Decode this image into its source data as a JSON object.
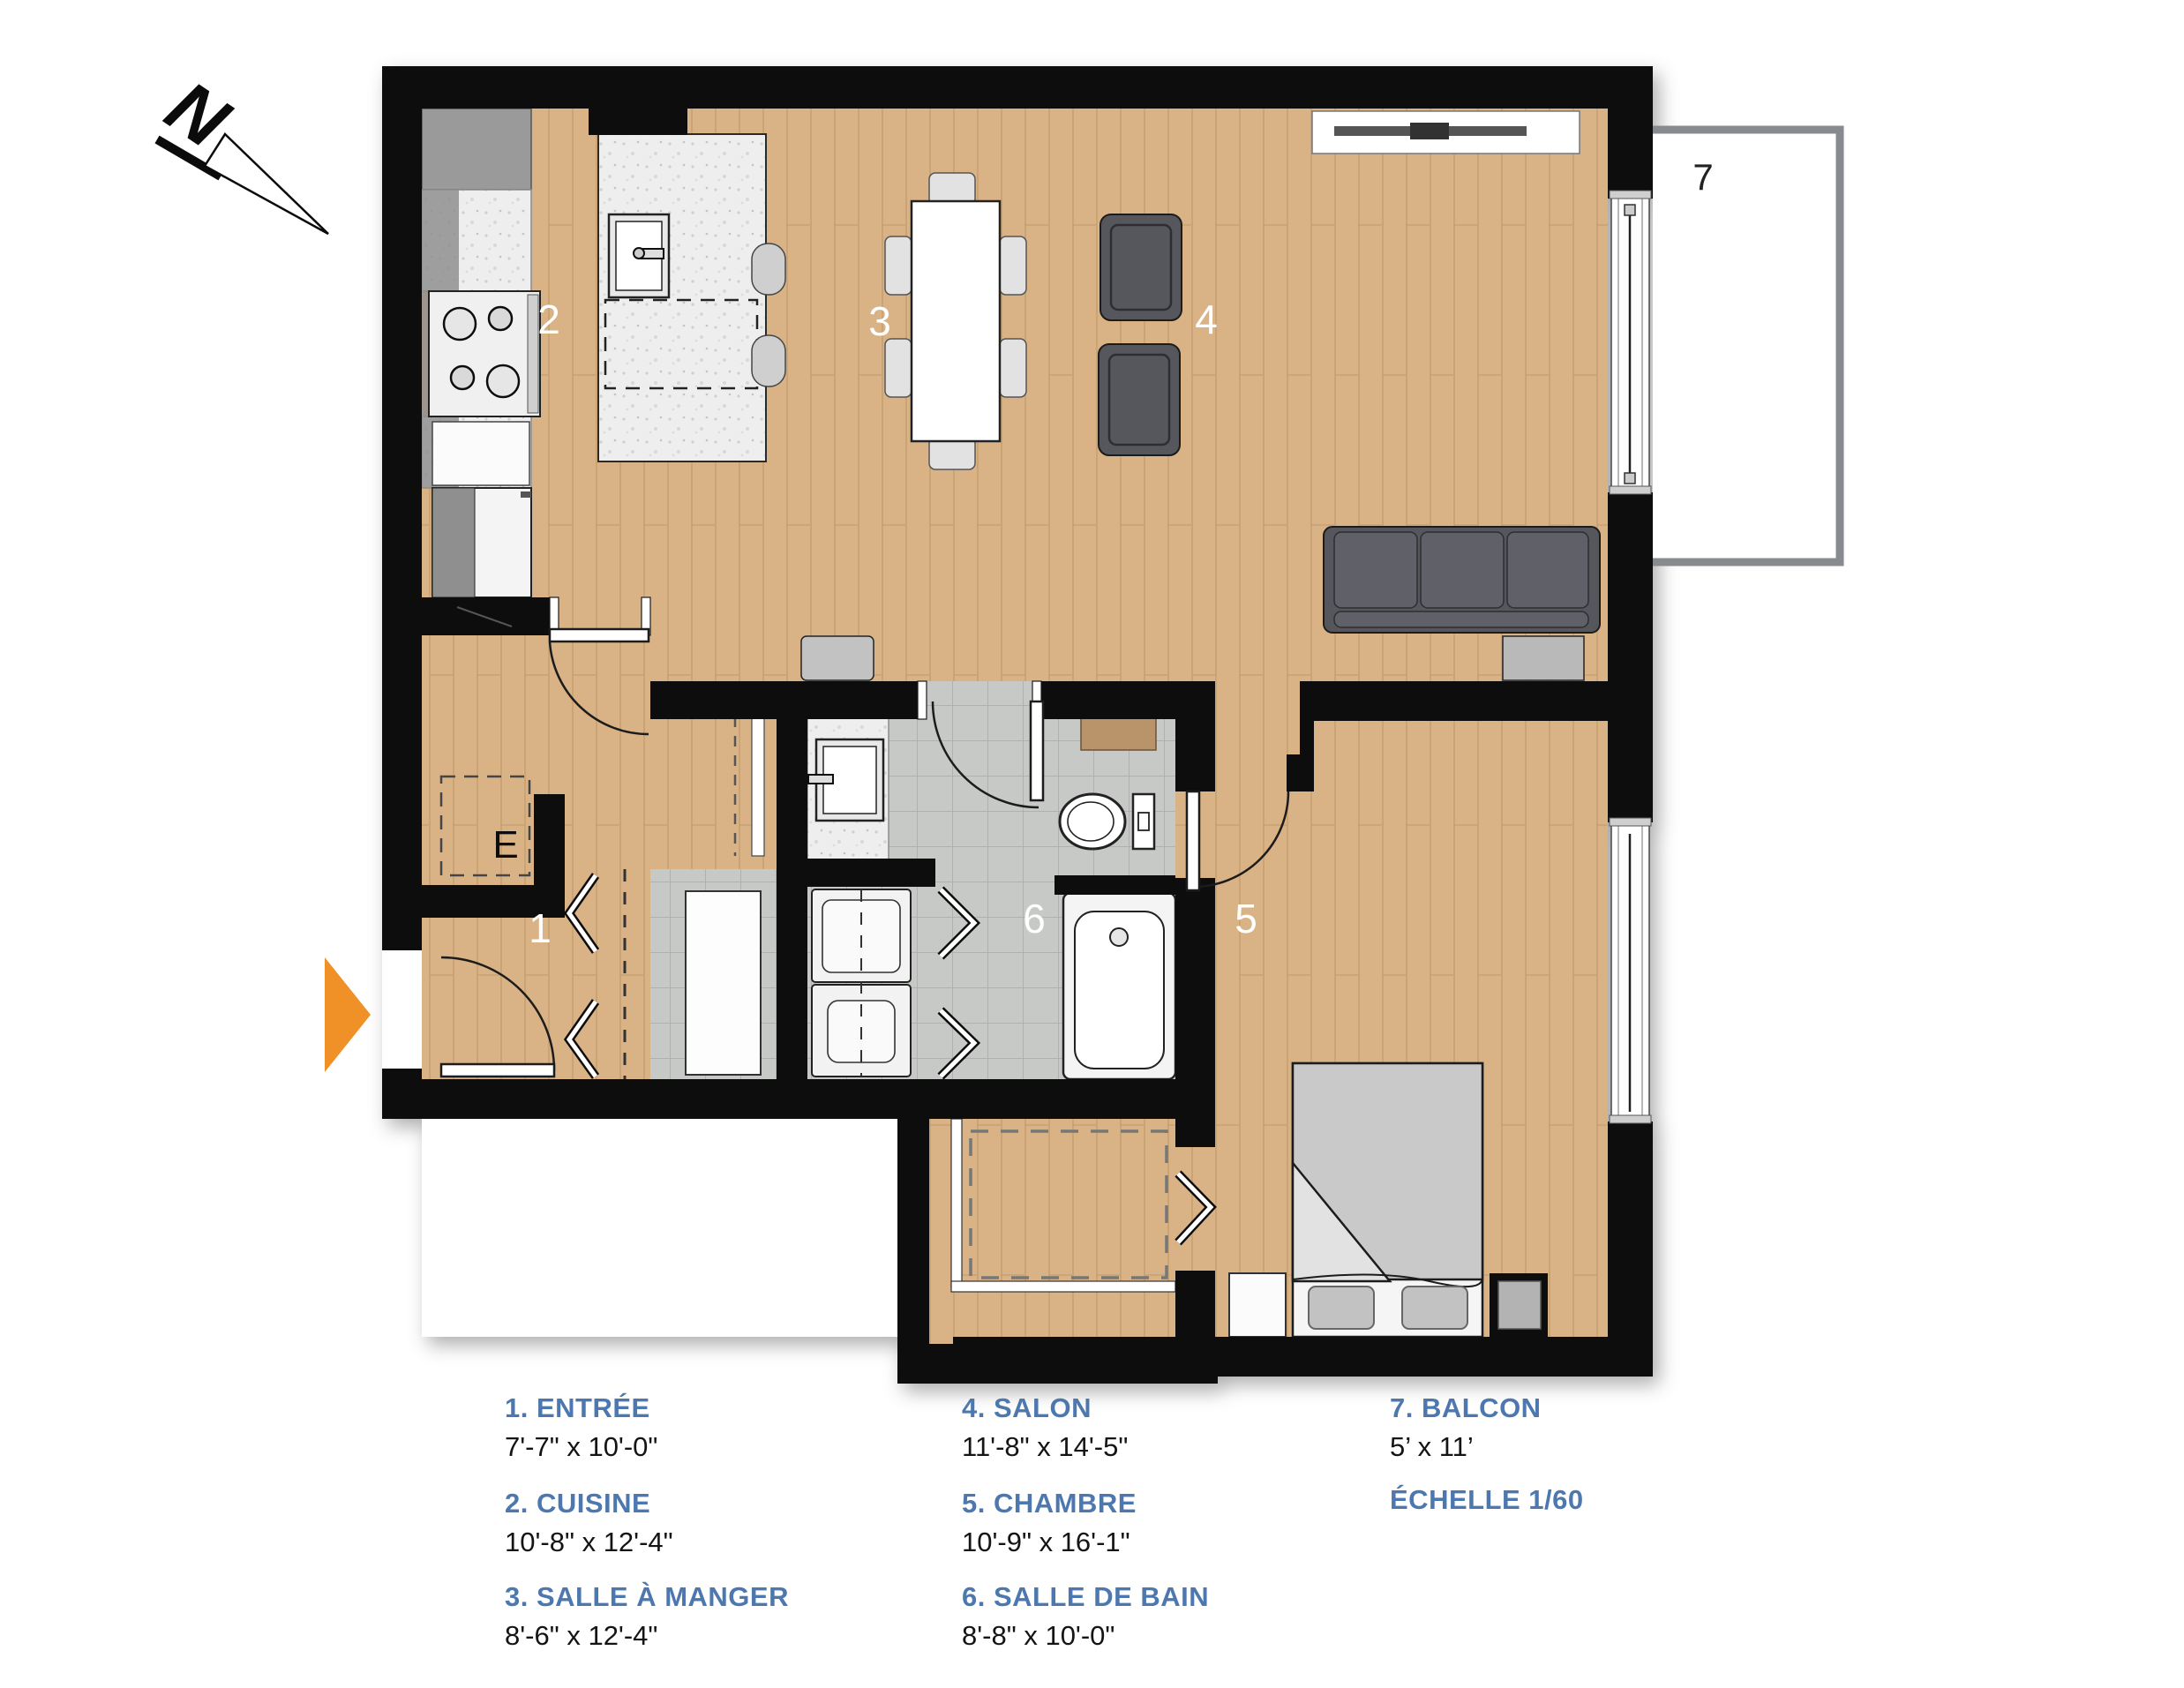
{
  "title": "Plan d'étage – appartement",
  "colors": {
    "accent_blue": "#4d78af",
    "wall_black": "#0c0c0c",
    "wood_floor": "#d9b286",
    "tile_gray": "#c7c9c6",
    "entrance_arrow_orange": "#f09128",
    "balcony_border_gray": "#878b8f",
    "sofa_gray": "#56575d"
  },
  "north": {
    "label": "N"
  },
  "electrical_panel_label": "E",
  "scale_label": "ÉCHELLE 1/60",
  "rooms": [
    {
      "number": "1",
      "legend_label": "1. ENTRÉE",
      "dims": "7'-7\" x 10'-0\""
    },
    {
      "number": "2",
      "legend_label": "2. CUISINE",
      "dims": "10'-8\" x 12'-4\""
    },
    {
      "number": "3",
      "legend_label": "3. SALLE À MANGER",
      "dims": "8'-6\" x 12'-4\""
    },
    {
      "number": "4",
      "legend_label": "4. SALON",
      "dims": "11'-8\" x 14'-5\""
    },
    {
      "number": "5",
      "legend_label": "5. CHAMBRE",
      "dims": "10'-9\" x 16'-1\""
    },
    {
      "number": "6",
      "legend_label": "6. SALLE DE BAIN",
      "dims": "8'-8\" x 10'-0\""
    },
    {
      "number": "7",
      "legend_label": "7. BALCON",
      "dims": "5’ x 11’"
    }
  ]
}
